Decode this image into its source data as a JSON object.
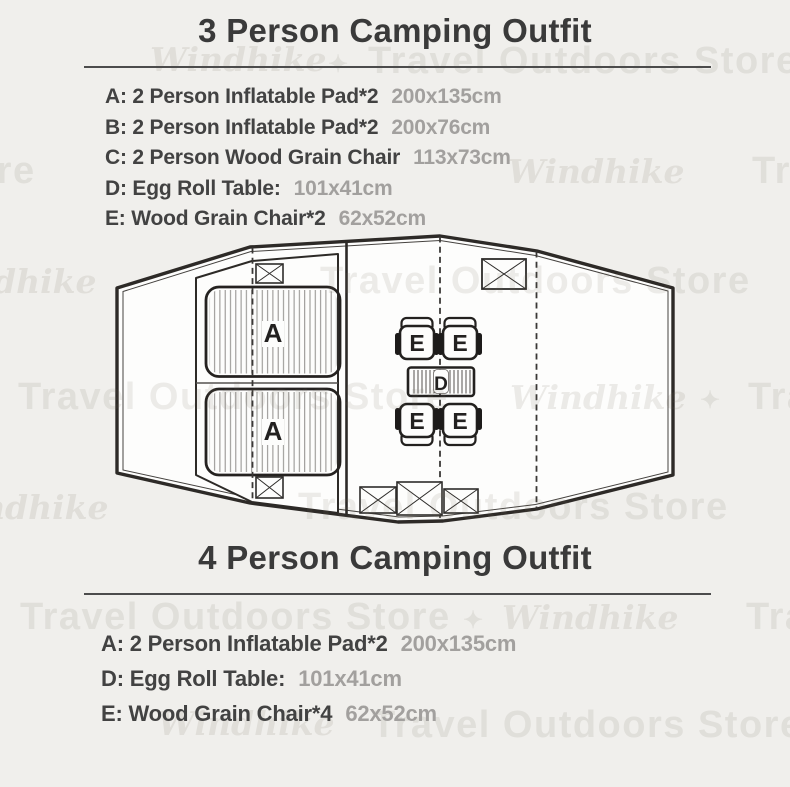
{
  "section_top": {
    "title": "3 Person Camping Outfit",
    "items": [
      {
        "label": "A: 2 Person Inflatable Pad*2",
        "size": "200x135cm"
      },
      {
        "label": "B: 2 Person Inflatable Pad*2",
        "size": "200x76cm"
      },
      {
        "label": "C: 2 Person Wood Grain Chair",
        "size": "113x73cm"
      },
      {
        "label": "D: Egg Roll Table:",
        "size": "101x41cm"
      },
      {
        "label": "E: Wood Grain Chair*2",
        "size": "62x52cm"
      }
    ]
  },
  "section_bottom": {
    "title": "4 Person Camping Outfit",
    "items": [
      {
        "label": "A: 2 Person Inflatable Pad*2",
        "size": "200x135cm"
      },
      {
        "label": "D: Egg Roll Table:",
        "size": "101x41cm"
      },
      {
        "label": "E: Wood Grain Chair*4",
        "size": "62x52cm"
      }
    ]
  },
  "diagram": {
    "pad_labels": [
      "A",
      "A"
    ],
    "chair_labels": [
      "E",
      "E",
      "E",
      "E"
    ],
    "table_label": "D"
  },
  "colors": {
    "background": "#f0efec",
    "outline": "#2d2a27",
    "text_dark": "#3a3a3a",
    "text_gray": "#a2a09e"
  },
  "watermarks": [
    {
      "text": "Windhike"
    },
    {
      "text": "Travel Outdoors Store"
    },
    {
      "text": "✦"
    },
    {
      "text": "Travel Outdoors Store"
    },
    {
      "text": "Windhike"
    },
    {
      "text": "Travel Outdoors Store"
    },
    {
      "text": "Travel Outdoors Store"
    },
    {
      "text": "Windhike"
    },
    {
      "text": "Travel Outdoors Store"
    },
    {
      "text": "Windhike"
    },
    {
      "text": "Travel Outdoors Store"
    },
    {
      "text": "✦"
    },
    {
      "text": "Windhike"
    },
    {
      "text": "Travel Outdoors Store"
    },
    {
      "text": "Travel Outdoors Store"
    },
    {
      "text": "Windhike"
    },
    {
      "text": "✦"
    },
    {
      "text": "Travel Outdoors Store"
    },
    {
      "text": "Windhike"
    },
    {
      "text": "Travel Outdoors Store"
    }
  ]
}
